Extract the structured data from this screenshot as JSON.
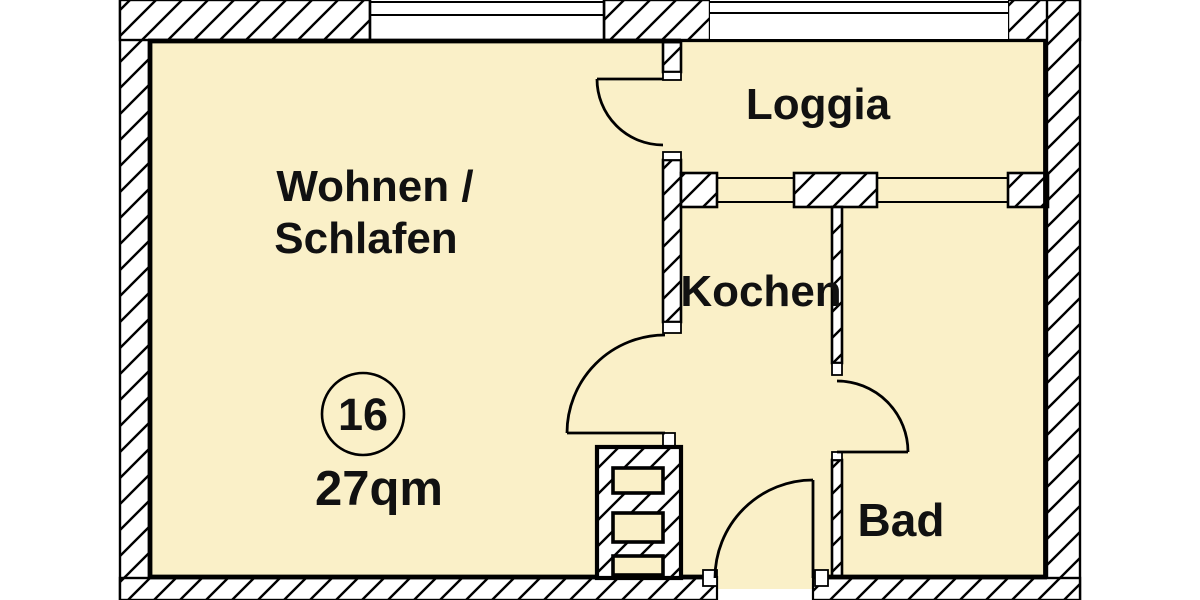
{
  "plan": {
    "type": "apartment-floor-plan",
    "rooms": [
      {
        "id": "wohnen-schlafen",
        "label_line1": "Wohnen /",
        "label_line2": "Schlafen"
      },
      {
        "id": "loggia",
        "label": "Loggia"
      },
      {
        "id": "kochen",
        "label": "Kochen"
      },
      {
        "id": "bad",
        "label": "Bad"
      }
    ],
    "unit": {
      "number": "16",
      "area": "27qm"
    },
    "features": [
      "loggia-door",
      "kochen-door",
      "bad-door",
      "entrance-door",
      "installation-shaft",
      "top-window",
      "loggia-railing",
      "loggia-window-left",
      "loggia-window-right"
    ],
    "colors": {
      "room_fill": "#FAF0C8",
      "wall_line": "#000000",
      "background": "#FFFFFF",
      "text": "#111111"
    }
  }
}
